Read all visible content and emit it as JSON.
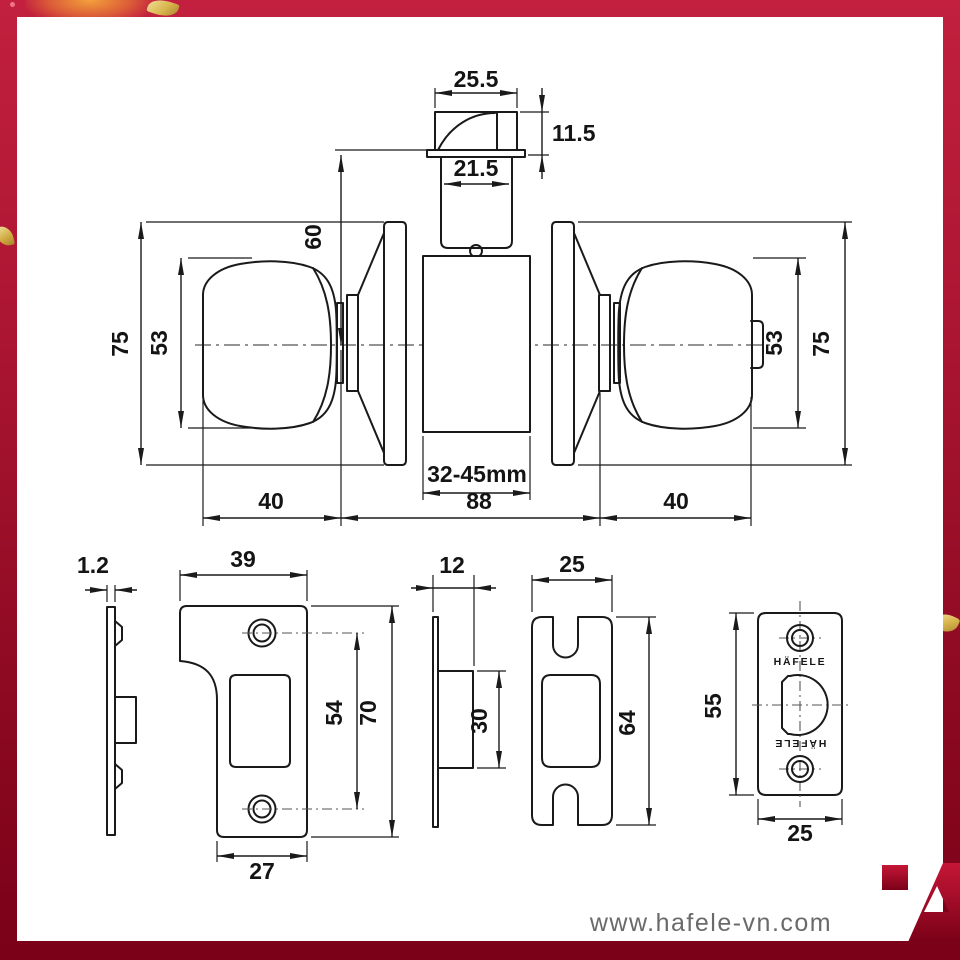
{
  "colors": {
    "border_red_top": "#c2203e",
    "border_red_bottom": "#7a0118",
    "drawing_line": "#1a1a1a",
    "footer_text": "#6a6a6a",
    "logo_red": "#c51636",
    "confetti_gold": "#d9b64e"
  },
  "assembly": {
    "bolt_width": "25.5",
    "bolt_height": "11.5",
    "spindle_tube_width": "21.5",
    "center_to_latch": "60",
    "rose_dia_left": "75",
    "knob_dia_left": "53",
    "knob_dia_right": "53",
    "rose_dia_right": "75",
    "door_thickness": "32-45mm",
    "knob_projection_left": "40",
    "body_length": "88",
    "knob_projection_right": "40"
  },
  "strike_plate": {
    "thickness": "1.2",
    "width": "39",
    "hole_spacing": "54",
    "height": "70",
    "bottom_width": "27"
  },
  "latch_side": {
    "depth": "12",
    "housing_height": "30"
  },
  "latch_front": {
    "width": "25",
    "height": "64"
  },
  "bolt_faceplate": {
    "height": "55",
    "width": "25",
    "brand_top": "HÄFELE",
    "brand_bottom": "HÄFELE"
  },
  "footer": {
    "website": "www.hafele-vn.com"
  }
}
